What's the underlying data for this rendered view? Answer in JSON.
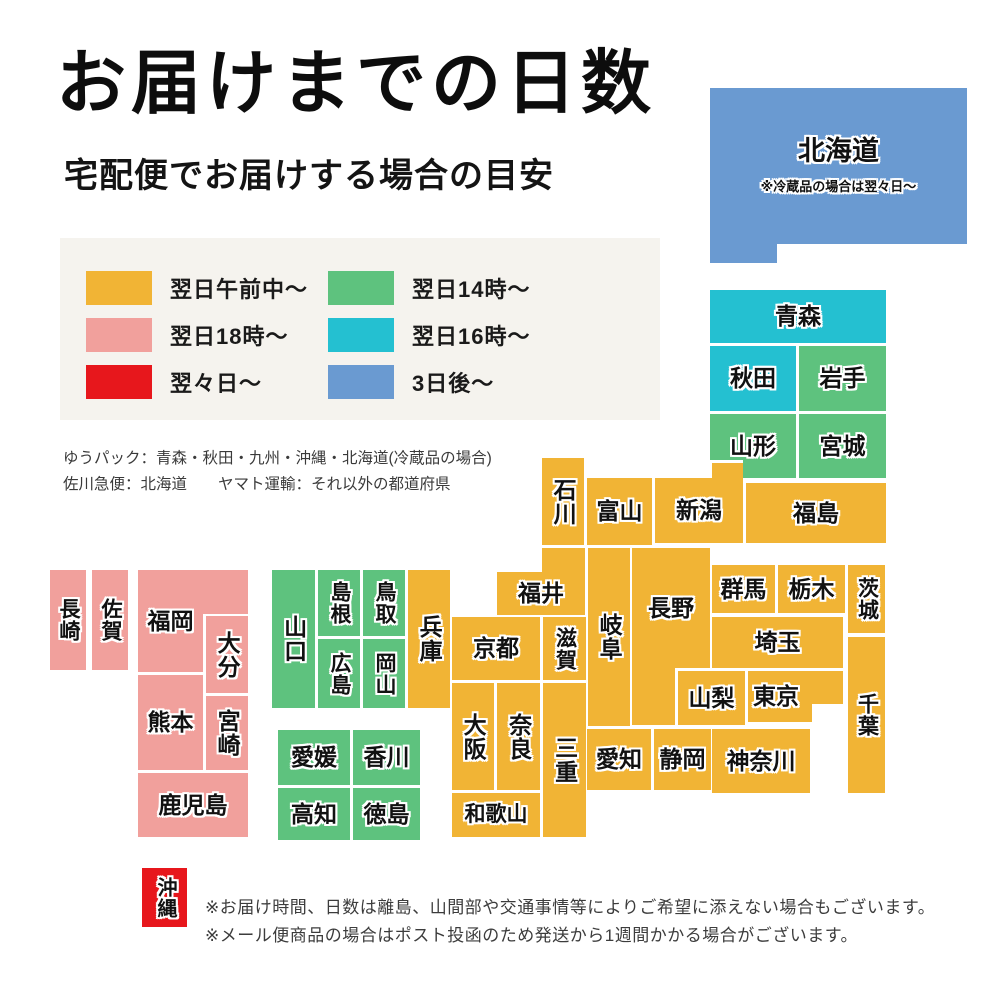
{
  "title": "お届けまでの日数",
  "subtitle": "宅配便でお届けする場合の目安",
  "colors": {
    "yellow": "#F1B435",
    "green": "#5EC27E",
    "teal": "#24C0D1",
    "pink": "#F1A09C",
    "red": "#E7171C",
    "blue": "#6A9AD1",
    "white": "#FFFFFF",
    "legend_box_bg": "#F5F3EE"
  },
  "legend": {
    "items": [
      {
        "label": "翌日午前中〜",
        "color_key": "yellow"
      },
      {
        "label": "翌日18時〜",
        "color_key": "pink"
      },
      {
        "label": "翌々日〜",
        "color_key": "red"
      },
      {
        "label": "翌日14時〜",
        "color_key": "green"
      },
      {
        "label": "翌日16時〜",
        "color_key": "teal"
      },
      {
        "label": "3日後〜",
        "color_key": "blue"
      }
    ]
  },
  "carrier_notes": [
    "ゆうパック：青森・秋田・九州・沖縄・北海道(冷蔵品の場合)",
    "佐川急便：北海道　　ヤマト運輸：それ以外の都道府県"
  ],
  "map": {
    "blocks": [
      {
        "id": "hokkaido",
        "label": "北海道",
        "note": "※冷蔵品の場合は翌々日〜",
        "x": 710,
        "y": 88,
        "w": 257,
        "h": 156,
        "color": "blue",
        "fs": 27
      },
      {
        "id": "hokkaido-foot",
        "x": 710,
        "y": 243,
        "w": 67,
        "h": 20,
        "color": "blue"
      },
      {
        "id": "aomori",
        "label": "青森",
        "x": 710,
        "y": 290,
        "w": 176,
        "h": 53,
        "color": "teal"
      },
      {
        "id": "akita",
        "label": "秋田",
        "x": 710,
        "y": 346,
        "w": 86,
        "h": 65,
        "color": "teal"
      },
      {
        "id": "iwate",
        "label": "岩手",
        "x": 799,
        "y": 346,
        "w": 87,
        "h": 65,
        "color": "green"
      },
      {
        "id": "yamagata",
        "label": "山形",
        "x": 710,
        "y": 414,
        "w": 86,
        "h": 64,
        "color": "green"
      },
      {
        "id": "miyagi",
        "label": "宮城",
        "x": 799,
        "y": 414,
        "w": 87,
        "h": 64,
        "color": "green"
      },
      {
        "id": "niigata-bump",
        "x": 709,
        "y": 460,
        "w": 34,
        "h": 23,
        "color": "yellow",
        "divider": true
      },
      {
        "id": "niigata",
        "label": "新潟",
        "x": 655,
        "y": 478,
        "w": 88,
        "h": 65,
        "color": "yellow"
      },
      {
        "id": "fukushima",
        "label": "福島",
        "x": 746,
        "y": 483,
        "w": 140,
        "h": 60,
        "color": "yellow"
      },
      {
        "id": "ishikawa",
        "label": "石川",
        "x": 542,
        "y": 458,
        "w": 42,
        "h": 87,
        "color": "yellow",
        "vertical": true
      },
      {
        "id": "toyama",
        "label": "富山",
        "x": 587,
        "y": 478,
        "w": 65,
        "h": 67,
        "color": "yellow"
      },
      {
        "id": "fukui-bump",
        "x": 542,
        "y": 548,
        "w": 43,
        "h": 27,
        "color": "yellow"
      },
      {
        "id": "fukui",
        "label": "福井",
        "x": 497,
        "y": 572,
        "w": 88,
        "h": 43,
        "color": "yellow"
      },
      {
        "id": "gifu",
        "label": "岐阜",
        "x": 588,
        "y": 548,
        "w": 42,
        "h": 178,
        "color": "yellow",
        "vertical": true
      },
      {
        "id": "nagano-leg",
        "x": 632,
        "y": 548,
        "w": 43,
        "h": 177,
        "color": "yellow"
      },
      {
        "id": "nagano",
        "label": "長野",
        "x": 632,
        "y": 548,
        "w": 78,
        "h": 120,
        "color": "yellow"
      },
      {
        "id": "gunma",
        "label": "群馬",
        "x": 712,
        "y": 565,
        "w": 63,
        "h": 48,
        "color": "yellow"
      },
      {
        "id": "tochigi",
        "label": "栃木",
        "x": 778,
        "y": 565,
        "w": 67,
        "h": 48,
        "color": "yellow"
      },
      {
        "id": "ibaraki",
        "label": "茨城",
        "x": 848,
        "y": 565,
        "w": 37,
        "h": 68,
        "color": "yellow",
        "vertical": true,
        "fs": 21
      },
      {
        "id": "saitama",
        "label": "埼玉",
        "x": 712,
        "y": 617,
        "w": 131,
        "h": 51,
        "color": "yellow"
      },
      {
        "id": "yamanashi",
        "label": "山梨",
        "x": 678,
        "y": 671,
        "w": 67,
        "h": 54,
        "color": "yellow"
      },
      {
        "id": "tokyo",
        "label": "東京",
        "x": 748,
        "y": 671,
        "w": 95,
        "h": 51,
        "color": "yellow",
        "align": "left"
      },
      {
        "id": "tokyo-bay-notch",
        "x": 812,
        "y": 704,
        "w": 31,
        "h": 19,
        "color": "white"
      },
      {
        "id": "chiba",
        "label": "千葉",
        "x": 848,
        "y": 637,
        "w": 37,
        "h": 156,
        "color": "yellow",
        "vertical": true,
        "fs": 21
      },
      {
        "id": "kanagawa",
        "label": "神奈川",
        "x": 712,
        "y": 729,
        "w": 98,
        "h": 64,
        "color": "yellow"
      },
      {
        "id": "shizuoka",
        "label": "静岡",
        "x": 654,
        "y": 729,
        "w": 57,
        "h": 61,
        "color": "yellow"
      },
      {
        "id": "aichi",
        "label": "愛知",
        "x": 587,
        "y": 729,
        "w": 64,
        "h": 61,
        "color": "yellow"
      },
      {
        "id": "kyoto",
        "label": "京都",
        "x": 452,
        "y": 617,
        "w": 88,
        "h": 63,
        "color": "yellow"
      },
      {
        "id": "shiga",
        "label": "滋賀",
        "x": 543,
        "y": 617,
        "w": 43,
        "h": 63,
        "color": "yellow",
        "vertical": true,
        "fs": 21
      },
      {
        "id": "osaka",
        "label": "大阪",
        "x": 452,
        "y": 683,
        "w": 42,
        "h": 107,
        "color": "yellow",
        "vertical": true
      },
      {
        "id": "nara",
        "label": "奈良",
        "x": 497,
        "y": 683,
        "w": 43,
        "h": 107,
        "color": "yellow",
        "vertical": true
      },
      {
        "id": "mie",
        "label": "三重",
        "x": 543,
        "y": 683,
        "w": 43,
        "h": 154,
        "color": "yellow",
        "vertical": true
      },
      {
        "id": "wakayama",
        "label": "和歌山",
        "x": 452,
        "y": 793,
        "w": 88,
        "h": 44,
        "color": "yellow",
        "fs": 21
      },
      {
        "id": "hyogo",
        "label": "兵庫",
        "x": 408,
        "y": 570,
        "w": 42,
        "h": 138,
        "color": "yellow",
        "vertical": true
      },
      {
        "id": "yamaguchi",
        "label": "山口",
        "x": 272,
        "y": 570,
        "w": 43,
        "h": 138,
        "color": "green",
        "vertical": true
      },
      {
        "id": "shimane",
        "label": "島根",
        "x": 318,
        "y": 570,
        "w": 42,
        "h": 66,
        "color": "green",
        "vertical": true,
        "fs": 21
      },
      {
        "id": "hiroshima",
        "label": "広島",
        "x": 318,
        "y": 639,
        "w": 42,
        "h": 69,
        "color": "green",
        "vertical": true,
        "fs": 21
      },
      {
        "id": "tottori",
        "label": "鳥取",
        "x": 363,
        "y": 570,
        "w": 42,
        "h": 66,
        "color": "green",
        "vertical": true,
        "fs": 21
      },
      {
        "id": "okayama",
        "label": "岡山",
        "x": 363,
        "y": 639,
        "w": 42,
        "h": 69,
        "color": "green",
        "vertical": true,
        "fs": 21
      },
      {
        "id": "ehime",
        "label": "愛媛",
        "x": 278,
        "y": 730,
        "w": 72,
        "h": 55,
        "color": "green"
      },
      {
        "id": "kagawa",
        "label": "香川",
        "x": 353,
        "y": 730,
        "w": 67,
        "h": 55,
        "color": "green"
      },
      {
        "id": "kochi",
        "label": "高知",
        "x": 278,
        "y": 788,
        "w": 72,
        "h": 52,
        "color": "green"
      },
      {
        "id": "tokushima",
        "label": "徳島",
        "x": 353,
        "y": 788,
        "w": 67,
        "h": 52,
        "color": "green"
      },
      {
        "id": "nagasaki",
        "label": "長崎",
        "x": 50,
        "y": 570,
        "w": 36,
        "h": 100,
        "color": "pink",
        "vertical": true,
        "fs": 21
      },
      {
        "id": "saga",
        "label": "佐賀",
        "x": 92,
        "y": 570,
        "w": 36,
        "h": 100,
        "color": "pink",
        "vertical": true,
        "fs": 21
      },
      {
        "id": "fukuoka-top",
        "x": 138,
        "y": 570,
        "w": 110,
        "h": 44,
        "color": "pink"
      },
      {
        "id": "fukuoka",
        "label": "福岡",
        "x": 138,
        "y": 570,
        "w": 65,
        "h": 102,
        "color": "pink"
      },
      {
        "id": "oita",
        "label": "大分",
        "x": 206,
        "y": 616,
        "w": 42,
        "h": 77,
        "color": "pink",
        "vertical": true
      },
      {
        "id": "kumamoto",
        "label": "熊本",
        "x": 138,
        "y": 675,
        "w": 65,
        "h": 95,
        "color": "pink"
      },
      {
        "id": "miyazaki",
        "label": "宮崎",
        "x": 206,
        "y": 696,
        "w": 42,
        "h": 74,
        "color": "pink",
        "vertical": true
      },
      {
        "id": "kagoshima",
        "label": "鹿児島",
        "x": 138,
        "y": 773,
        "w": 110,
        "h": 64,
        "color": "pink"
      },
      {
        "id": "okinawa",
        "label": "沖縄",
        "x": 142,
        "y": 868,
        "w": 45,
        "h": 59,
        "color": "red",
        "fs": 20,
        "vertical": true
      }
    ]
  },
  "footnotes": [
    "※お届け時間、日数は離島、山間部や交通事情等によりご希望に添えない場合もございます。",
    "※メール便商品の場合はポスト投函のため発送から1週間かかる場合がございます。"
  ]
}
